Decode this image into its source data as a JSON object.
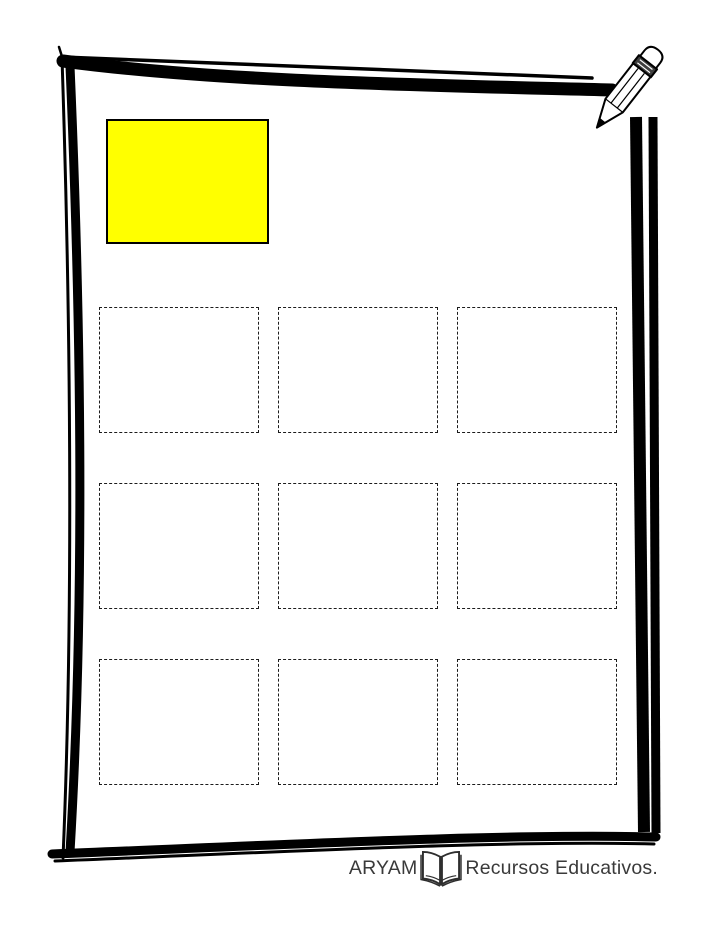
{
  "page": {
    "background_color": "#ffffff"
  },
  "frame": {
    "color": "#000000",
    "style": "hand-drawn-double-line"
  },
  "model_box": {
    "fill_color": "#ffff00",
    "border_color": "#000000"
  },
  "answer_grid": {
    "rows": 3,
    "columns": 3,
    "count": 9,
    "border_style": "dashed",
    "border_color": "#1c1c1c"
  },
  "decorations": {
    "pencil": "pencil-icon"
  },
  "footer": {
    "brand": "ARYAM",
    "text": "Recursos Educativos.",
    "icon": "open-book-icon",
    "color": "#3a3a3a"
  }
}
